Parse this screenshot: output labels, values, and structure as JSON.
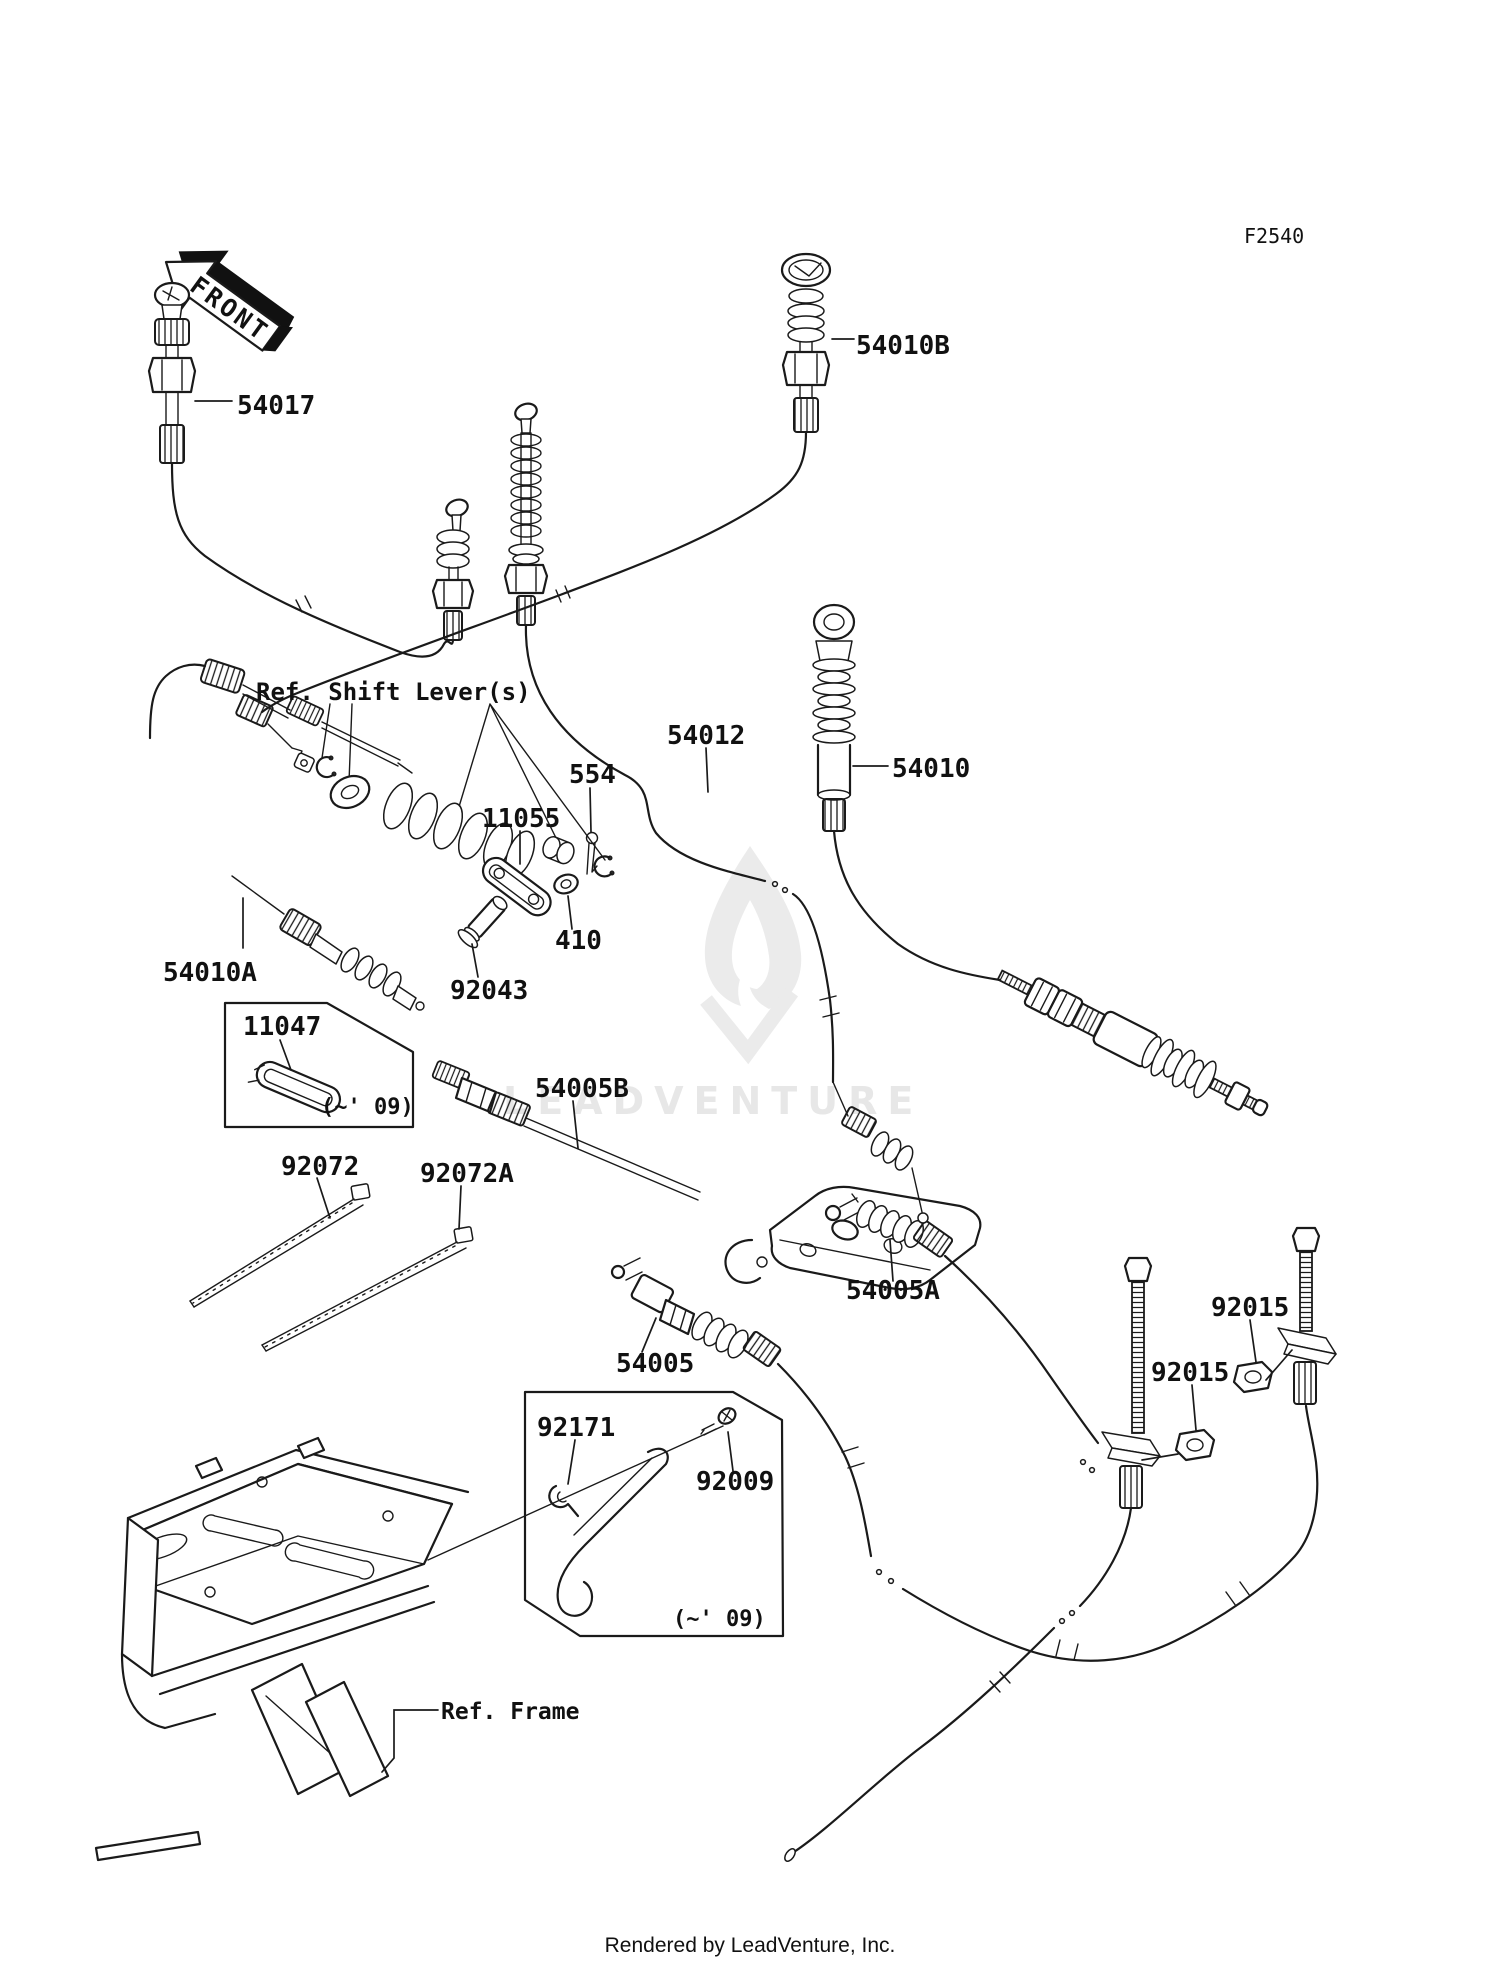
{
  "page": {
    "diagram_code": "F2540",
    "footer": "Rendered by LeadVenture, Inc."
  },
  "front_arrow": {
    "label": "FRONT"
  },
  "watermark": {
    "text": "LEADVENTURE"
  },
  "references": {
    "shift_lever": "Ref. Shift Lever(s)",
    "frame": "Ref. Frame"
  },
  "notes": {
    "model_year_a": "(~' 09)",
    "model_year_b": "(~' 09)"
  },
  "parts": {
    "p54017": {
      "number": "54017"
    },
    "p54010B": {
      "number": "54010B"
    },
    "p54012": {
      "number": "54012"
    },
    "p54010": {
      "number": "54010"
    },
    "p554": {
      "number": "554"
    },
    "p11055": {
      "number": "11055"
    },
    "p410": {
      "number": "410"
    },
    "p92043": {
      "number": "92043"
    },
    "p54010A": {
      "number": "54010A"
    },
    "p11047": {
      "number": "11047"
    },
    "p92072": {
      "number": "92072"
    },
    "p92072A": {
      "number": "92072A"
    },
    "p54005B": {
      "number": "54005B"
    },
    "p54005A": {
      "number": "54005A"
    },
    "p54005": {
      "number": "54005"
    },
    "p92015_upper": {
      "number": "92015"
    },
    "p92015_lower": {
      "number": "92015"
    },
    "p92171": {
      "number": "92171"
    },
    "p92009": {
      "number": "92009"
    }
  },
  "colors": {
    "line": "#1a1a1a",
    "background": "#ffffff",
    "watermark": "#e7e7e7"
  }
}
